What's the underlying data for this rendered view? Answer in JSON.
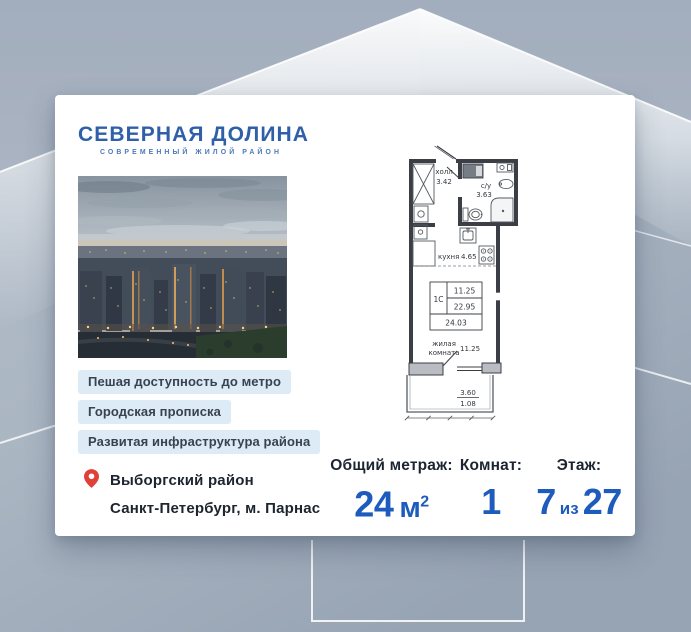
{
  "card": {
    "logo": {
      "title": "СЕВЕРНАЯ ДОЛИНА",
      "subtitle": "СОВРЕМЕННЫЙ ЖИЛОЙ РАЙОН"
    },
    "badges": [
      "Пешая доступность до метро",
      "Городская прописка",
      "Развитая инфраструктура района"
    ],
    "location": {
      "district": "Выборгский район",
      "city": "Санкт-Петербург, м. Парнас"
    },
    "floor_plan": {
      "hall_name": "холл",
      "hall_area": "3.42",
      "bathroom_name": "с/у",
      "bathroom_area": "3.63",
      "kitchen_name": "кухня",
      "kitchen_area": "4.65",
      "unit_type": "1С",
      "area_living": "11.25",
      "area_without_balcony": "22.95",
      "area_total": "24.03",
      "room_line1": "жилая",
      "room_line2": "комната",
      "room_area": "11.25",
      "balcony_dim_top": "3.60",
      "balcony_dim_bottom": "1.08"
    },
    "stats": {
      "area": {
        "label": "Общий метраж:",
        "value": "24",
        "unit": "м",
        "sup": "2"
      },
      "rooms": {
        "label": "Комнат:",
        "value": "1"
      },
      "floor": {
        "label": "Этаж:",
        "current": "7",
        "infix": "из",
        "total": "27"
      }
    }
  },
  "colors": {
    "accent_blue": "#1d5bbd",
    "logo_blue": "#2e5fa8",
    "badge_bg": "#dcebf5",
    "pin_red": "#e04038",
    "background_gray_blue": "#aab5c2"
  }
}
